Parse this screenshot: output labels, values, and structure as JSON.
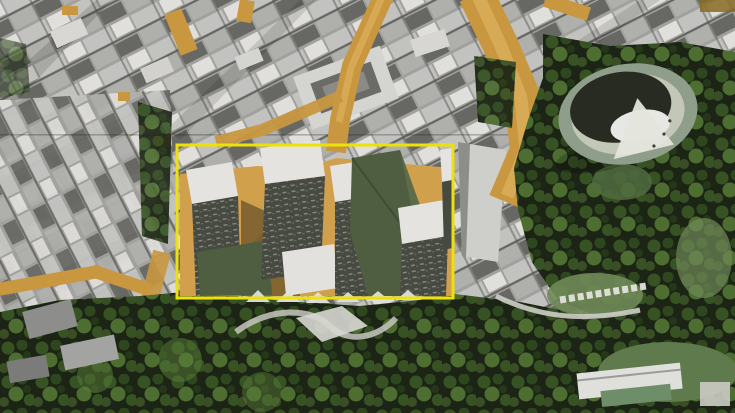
{
  "scene": {
    "kind": "aerial-masterplan-visualization",
    "colors": {
      "highlight_yellow": "#f3e600",
      "street_gold": "#cc983c",
      "street_gold_light": "#e2b45c",
      "street_gold_dark": "#8a6a1f",
      "plaza_tan": "#d4a24a",
      "plaza_shade": "#b5812f",
      "city_light": "#c6c6c3",
      "city_mid": "#a2a29f",
      "city_dark": "#5f5f5b",
      "roof_white": "#e9e8e4",
      "facade_dark": "#44473e",
      "roof_green": "#4c5b3d",
      "roof_green_light": "#5d6e49",
      "tree_dark": "#17200f",
      "tree_mid": "#33511f",
      "tree_light": "#587f35",
      "lawn": "#6f8a55",
      "arena_ring": "#8fa08b",
      "arena_terrace": "#c6cbba",
      "arena_bowl": "#22261c",
      "arena_floor": "#edeee8",
      "path_light": "#d2d2cb",
      "shadow_dark": "#131008"
    },
    "elements": {
      "highlight_box": {
        "x": 177,
        "y": 145,
        "w": 276,
        "h": 153
      },
      "arena": {
        "cx": 628,
        "cy": 114,
        "rx": 70,
        "ry": 50
      }
    }
  }
}
